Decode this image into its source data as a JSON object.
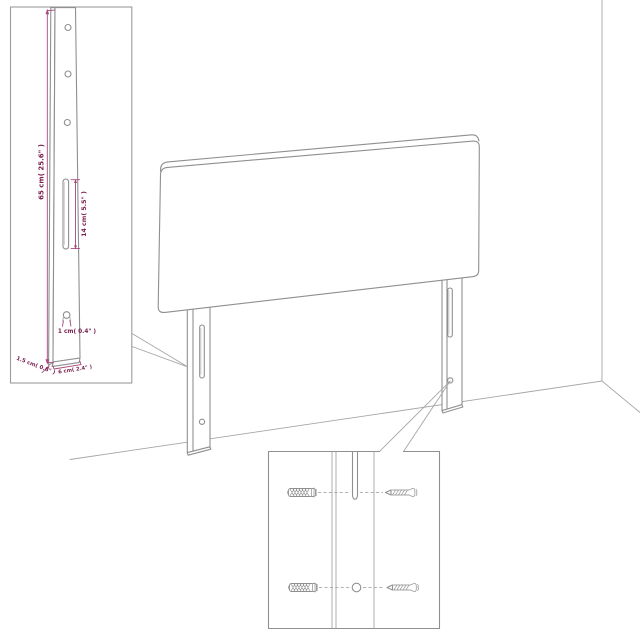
{
  "labels": {
    "leg_height": "65 cm( 25.6\" )",
    "slot_length": "14 cm( 5.5\" )",
    "keyhole_diameter": "1 cm( 0.4\" )",
    "leg_thickness": "1.5 cm( 0.6\" )",
    "leg_width": "6 cm( 2.4\" )"
  },
  "colors": {
    "dimension_text": "#7b2350",
    "dimension_line": "#a8487c",
    "outline_gray": "#8f8f8f",
    "background": "#ffffff"
  }
}
